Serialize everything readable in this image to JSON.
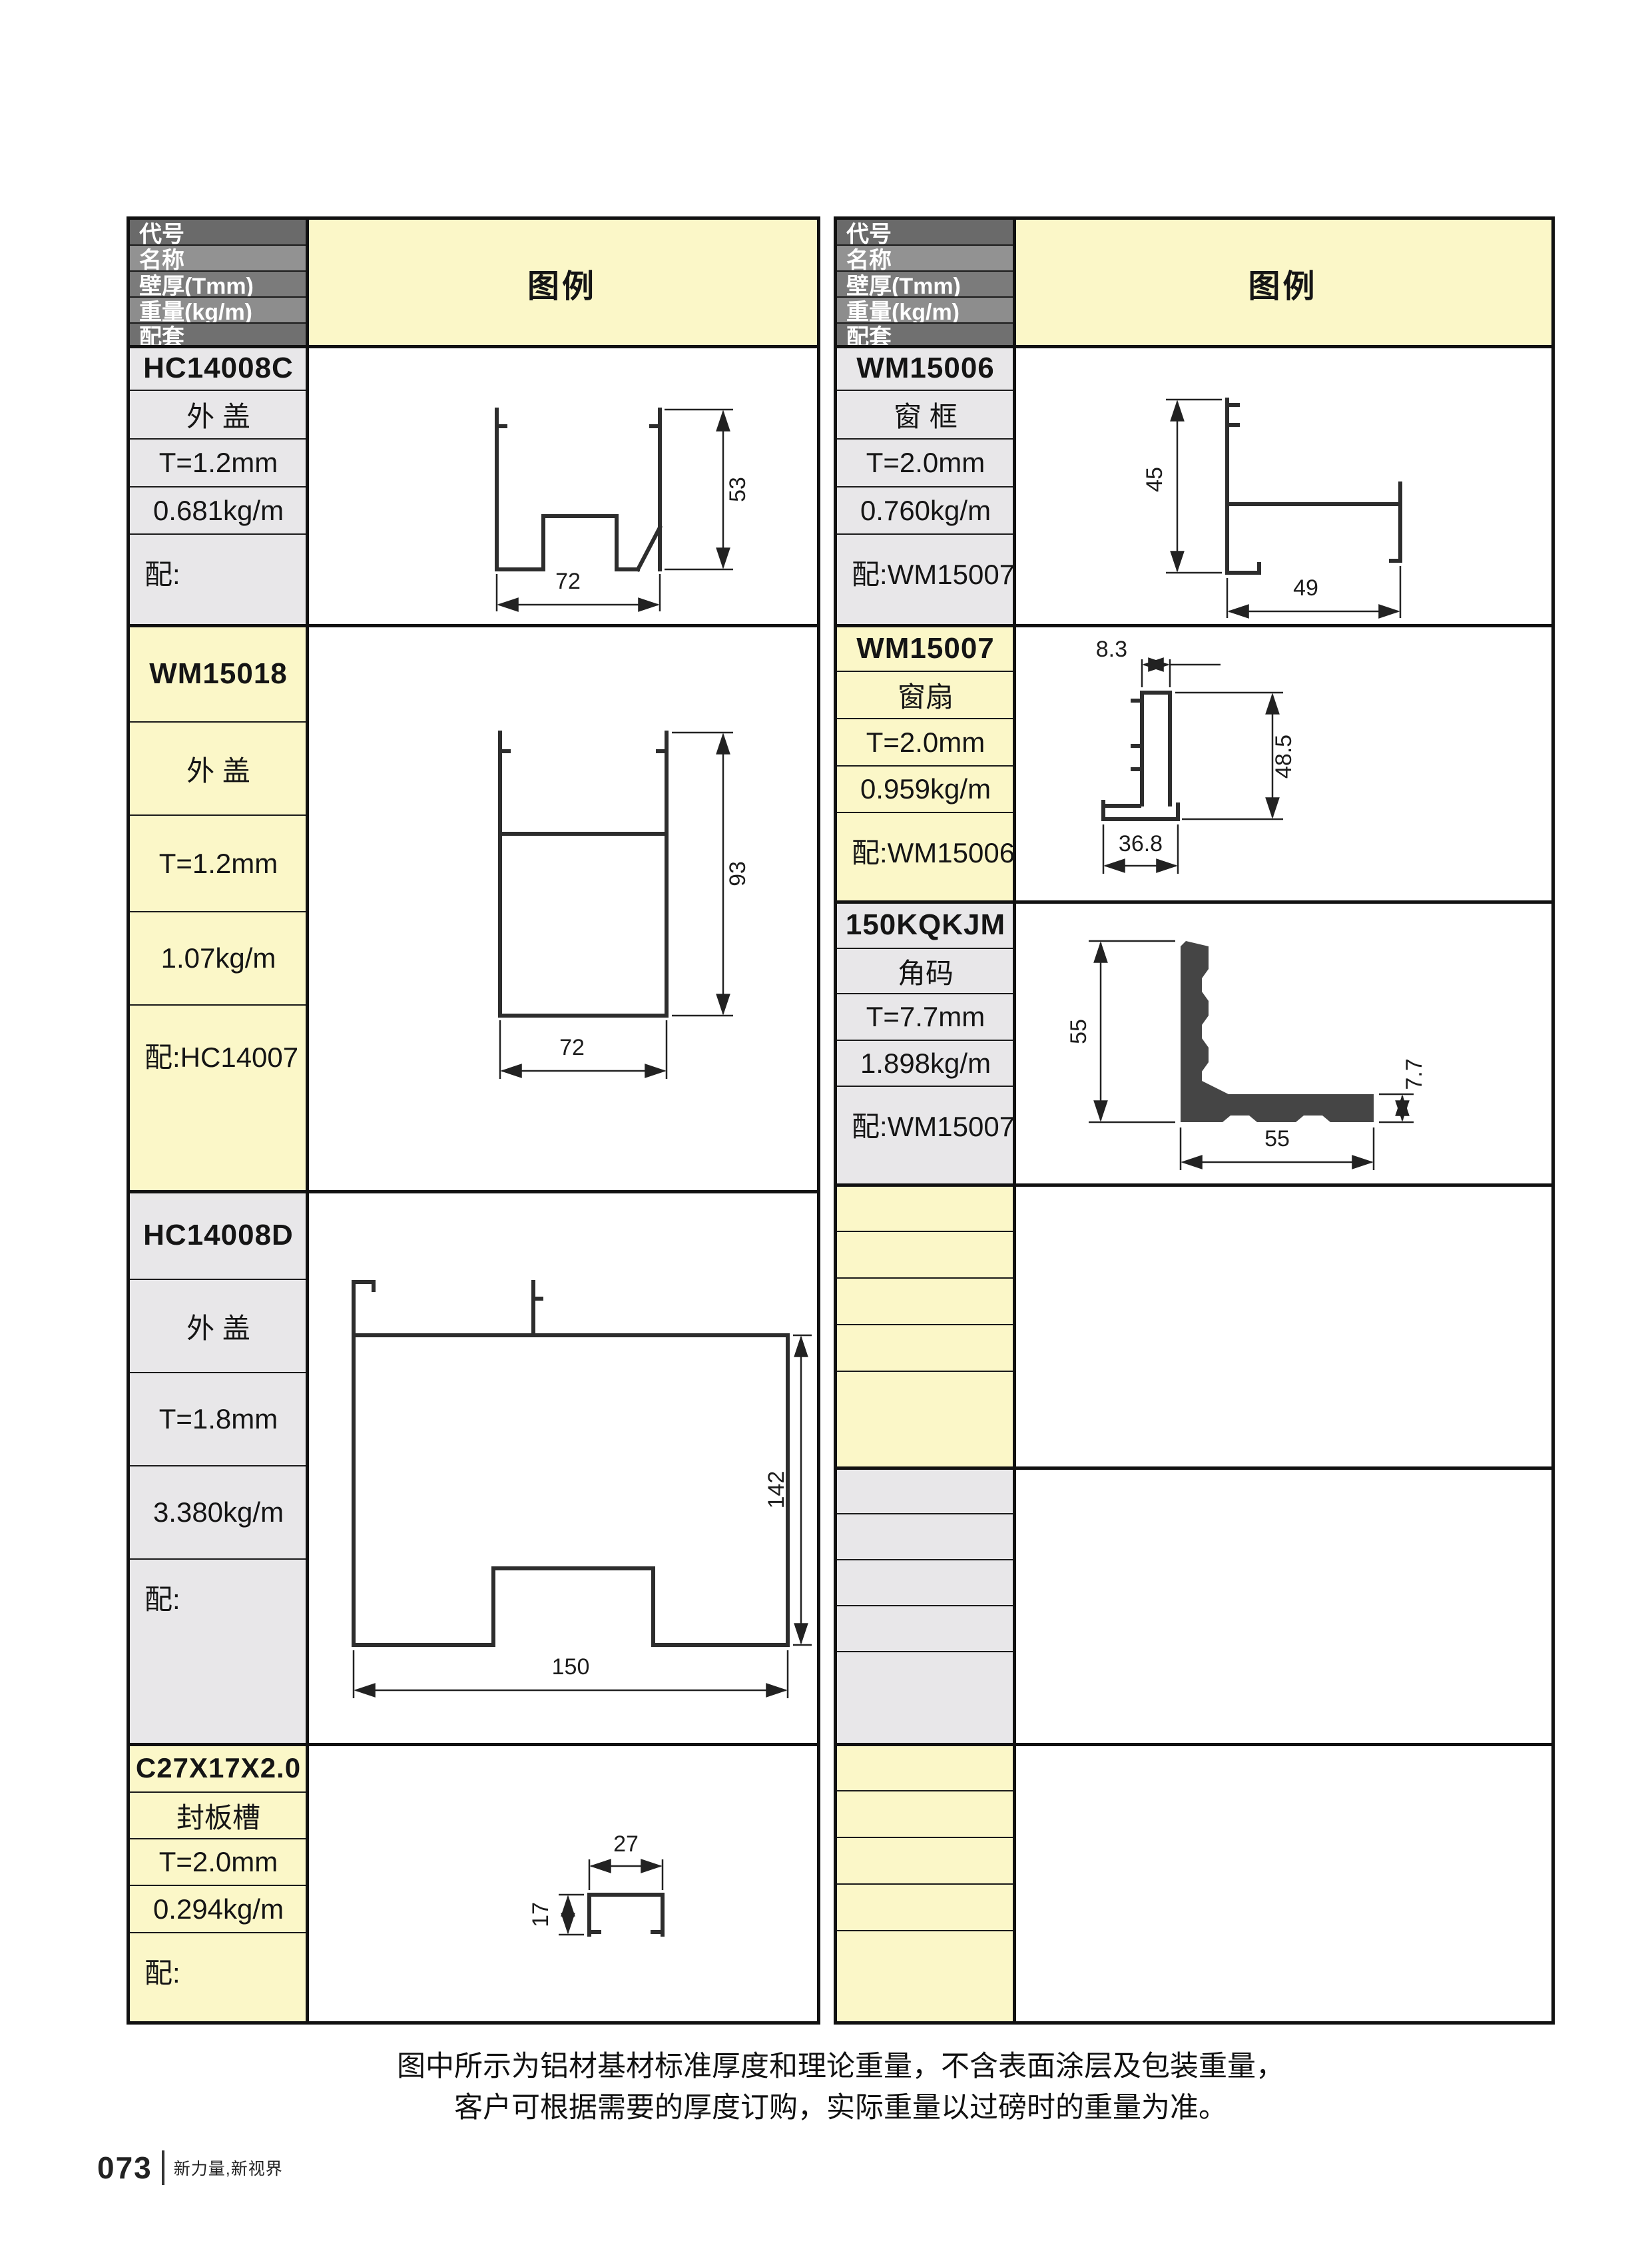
{
  "header_rows": [
    "代号",
    "名称",
    "壁厚(Tmm)",
    "重量(kg/m)",
    "配套"
  ],
  "legend_label": "图例",
  "left_group": {
    "blocks": [
      {
        "code": "HC14008C",
        "name": "外 盖",
        "thickness": "T=1.2mm",
        "weight": "0.681kg/m",
        "mate": "配:"
      },
      {
        "code": "WM15018",
        "name": "外 盖",
        "thickness": "T=1.2mm",
        "weight": "1.07kg/m",
        "mate": "配:HC14007"
      },
      {
        "code": "HC14008D",
        "name": "外 盖",
        "thickness": "T=1.8mm",
        "weight": "3.380kg/m",
        "mate": "配:"
      },
      {
        "code": "C27X17X2.0",
        "name": "封板槽",
        "thickness": "T=2.0mm",
        "weight": "0.294kg/m",
        "mate": "配:"
      }
    ]
  },
  "right_group": {
    "blocks": [
      {
        "code": "WM15006",
        "name": "窗 框",
        "thickness": "T=2.0mm",
        "weight": "0.760kg/m",
        "mate": "配:WM15007"
      },
      {
        "code": "WM15007",
        "name": "窗扇",
        "thickness": "T=2.0mm",
        "weight": "0.959kg/m",
        "mate": "配:WM15006"
      },
      {
        "code": "150KQKJM",
        "name": "角码",
        "thickness": "T=7.7mm",
        "weight": "1.898kg/m",
        "mate": "配:WM15007"
      }
    ]
  },
  "diagrams": {
    "d1": {
      "profile": "HC14008C",
      "width": "72",
      "height": "53"
    },
    "d2": {
      "profile": "WM15018",
      "width": "72",
      "height": "93"
    },
    "d3": {
      "profile": "HC14008D",
      "width": "150",
      "height": "142"
    },
    "d4": {
      "profile": "C27X17X2.0",
      "width": "27",
      "height": "17"
    },
    "d5": {
      "profile": "WM15006",
      "width": "49",
      "height": "45"
    },
    "d6": {
      "profile": "WM15007",
      "top_width": "8.3",
      "height": "48.5",
      "bottom_width": "36.8"
    },
    "d7": {
      "profile": "150KQKJM",
      "height": "55",
      "width": "55",
      "thickness": "7.7"
    }
  },
  "footnote": {
    "line1": "图中所示为铝材基材标准厚度和理论重量，不含表面涂层及包装重量，",
    "line2": "客户可根据需要的厚度订购，实际重量以过磅时的重量为准。"
  },
  "page_footer": {
    "number": "073",
    "slogan": "新力量,新视界"
  },
  "colors": {
    "yellow_cell": "#fbf7c8",
    "gray_cell": "#e8e7e9",
    "header_dark": "#6a6a6a",
    "header_medium": "#929292",
    "border": "#111111",
    "profile_stroke": "#2d2d2d",
    "bracket_fill": "#454545"
  }
}
